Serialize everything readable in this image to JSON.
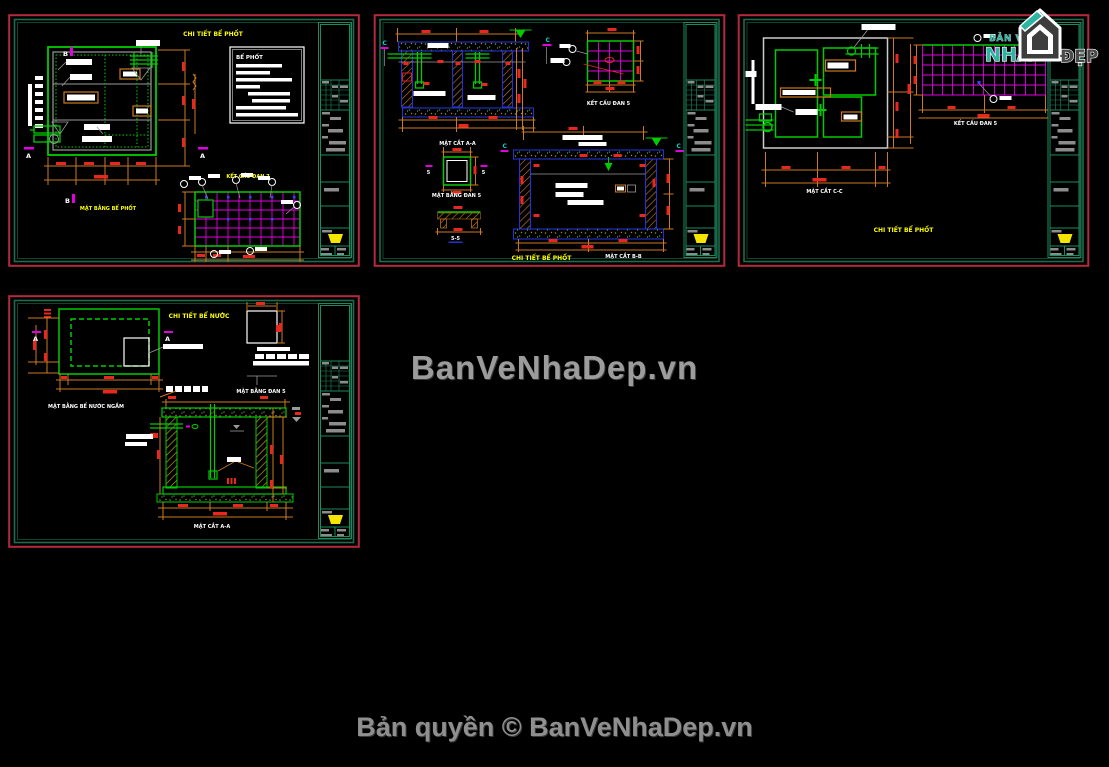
{
  "page": {
    "watermark": "BanVeNhaDep.vn",
    "copyright": "Bản quyền © BanVeNhaDep.vn",
    "background": "#000000"
  },
  "logo": {
    "top_text": "BẢN VẼ",
    "main_text": "NHÀ",
    "right_text": "ĐẸP",
    "teal": "#2cb5a2",
    "gray": "#4a4a4a"
  },
  "colors": {
    "sheet_border_outer": "#b22a3c",
    "sheet_border_inner": "#1d6b4b",
    "title_block_green": "#1d8a5e",
    "cad_green": "#00cc00",
    "cad_magenta": "#e000e0",
    "cad_orange": "#cc7a1f",
    "cad_red": "#e8281e",
    "cad_yellow": "#ffff00",
    "cad_cyan": "#00d0d0",
    "cad_blue": "#2233cc",
    "cad_white": "#ffffff",
    "cad_gray": "#9a9a9a"
  },
  "sheets": [
    {
      "name": "top-left",
      "title": "CHI TIẾT BỂ PHỐT",
      "labels": {
        "plan": "MẶT BẰNG BỂ PHỐT",
        "slab": "KẾT CẤU ĐAN 7",
        "note_title": "BỂ PHỐT"
      },
      "markers": {
        "b": "B",
        "a": "A"
      }
    },
    {
      "name": "top-middle",
      "title": "CHI TIẾT BỂ PHỐT",
      "labels": {
        "section_a": "MẶT CẮT A-A",
        "slab": "KẾT CẤU ĐAN 5",
        "plan_dan": "MẶT BẰNG ĐAN 5",
        "detail_55": "5-5",
        "section_b": "MẶT CẮT B-B"
      },
      "markers": {
        "c": "C",
        "five": "5"
      }
    },
    {
      "name": "top-right",
      "title": "CHI TIẾT BỂ PHỐT",
      "labels": {
        "section_c": "MẶT CẮT C-C",
        "slab": "KẾT CẤU ĐAN 5"
      }
    },
    {
      "name": "bottom-left",
      "title": "CHI TIẾT BỂ NƯỚC",
      "labels": {
        "plan": "MẶT BẰNG BỂ NƯỚC NGẦM",
        "plan_dan": "MẶT BẰNG ĐAN 5",
        "section_a": "MẶT CẮT A-A"
      },
      "markers": {
        "a": "A"
      }
    }
  ]
}
